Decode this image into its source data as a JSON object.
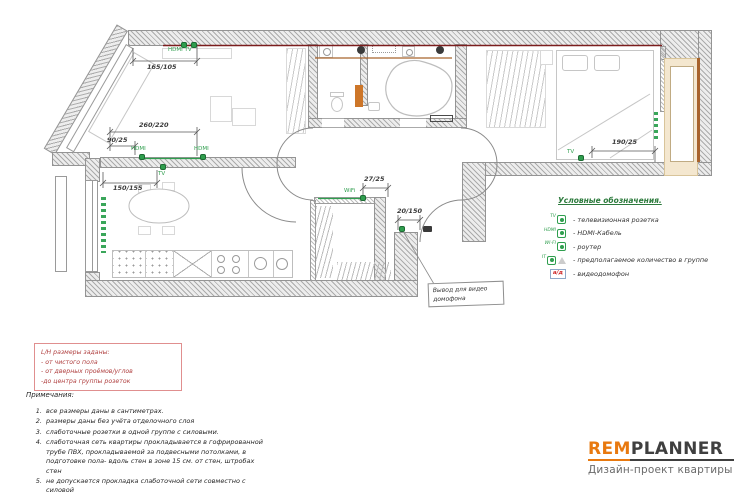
{
  "plan": {
    "sockets": {
      "hdmi_tv": "HDMI TV",
      "hdmi_a": "HDMI",
      "hdmi_b": "HDMI",
      "tv_kitchen": "TV",
      "wifi": "WiFi",
      "tv_bedroom": "TV"
    },
    "dims": {
      "living_top": "165/105",
      "living_a": "260/220",
      "living_b": "90/25",
      "kitchen": "150/155",
      "hall_top": "27/25",
      "entry": "20/150",
      "bedroom": "190/25"
    },
    "callout": "Вывод для видео домофона"
  },
  "legend": {
    "title": "Условные обозначения.",
    "items": [
      {
        "symbol": "TV",
        "label": "- телевизионная розетка"
      },
      {
        "symbol": "HDMI",
        "label": "- HDMI-Кабель"
      },
      {
        "symbol": "WI-FI",
        "label": "- роутер"
      },
      {
        "symbol": "IT",
        "label": "- предполагаемое количество в группе"
      },
      {
        "symbol": "а/д",
        "label": "- видеодомофон"
      }
    ]
  },
  "dim_note": {
    "lines": [
      "L/H размеры заданы:",
      "- от чистого пола",
      "- от дверных проёмов/углов",
      "-до центра группы розеток"
    ]
  },
  "notes": {
    "title": "Примечания:",
    "items": [
      {
        "n": "1.",
        "text": "все размеры даны в сантиметрах."
      },
      {
        "n": "2.",
        "text": "размеры даны без учёта отделочного слоя"
      },
      {
        "n": "3.",
        "text": "слаботочные розетки в одной группе с силовыми."
      },
      {
        "n": "4.",
        "text": "слаботочная сеть квартиры прокладывается в гофрированной трубе ПВХ, прокладываемой за подвесными потолками, в подготовке пола- вдоль стен в зоне 15 см. от стен, штробах стен"
      },
      {
        "n": "5.",
        "text": "не допускается прокладка слаботочной сети совместно с силовой"
      }
    ]
  },
  "logo": {
    "brand_a": "REM",
    "brand_b": "PLANNER",
    "subtitle": "Дизайн-проект квартиры"
  },
  "colors": {
    "socket_green": "#2f9e4e",
    "cable_red": "#7b1d1d",
    "note_red": "#b04040",
    "logo_orange": "#e8790f",
    "balcony_beige": "#f4e7cf",
    "wood_brown": "#a8632c"
  }
}
